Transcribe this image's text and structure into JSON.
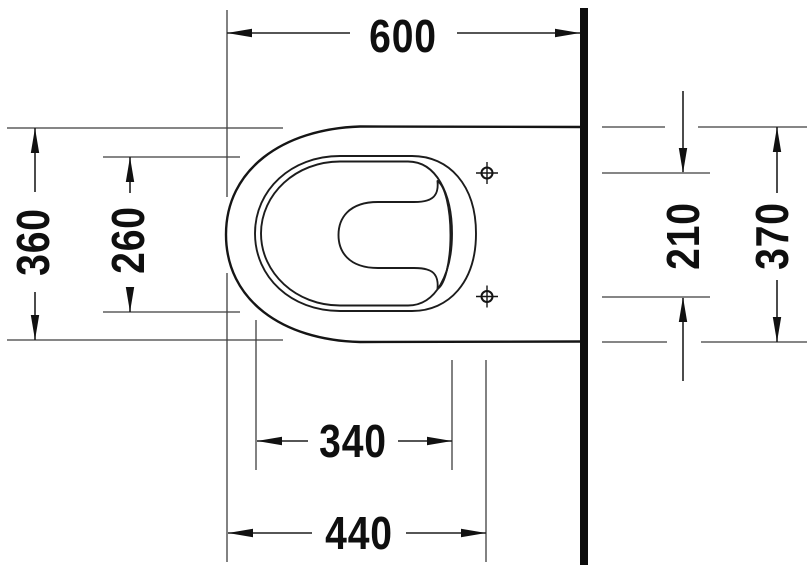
{
  "drawing": {
    "description": "Wall-mounted toilet, top view technical drawing",
    "unit": "mm",
    "line_color": "#111111",
    "background_color": "#ffffff",
    "dimensions": {
      "depth_overall": "600",
      "width_outer": "360",
      "width_seat_inner": "260",
      "fixing_hole_spacing": "210",
      "width_body": "370",
      "length_inner": "340",
      "length_to_fixing_holes": "440"
    }
  }
}
